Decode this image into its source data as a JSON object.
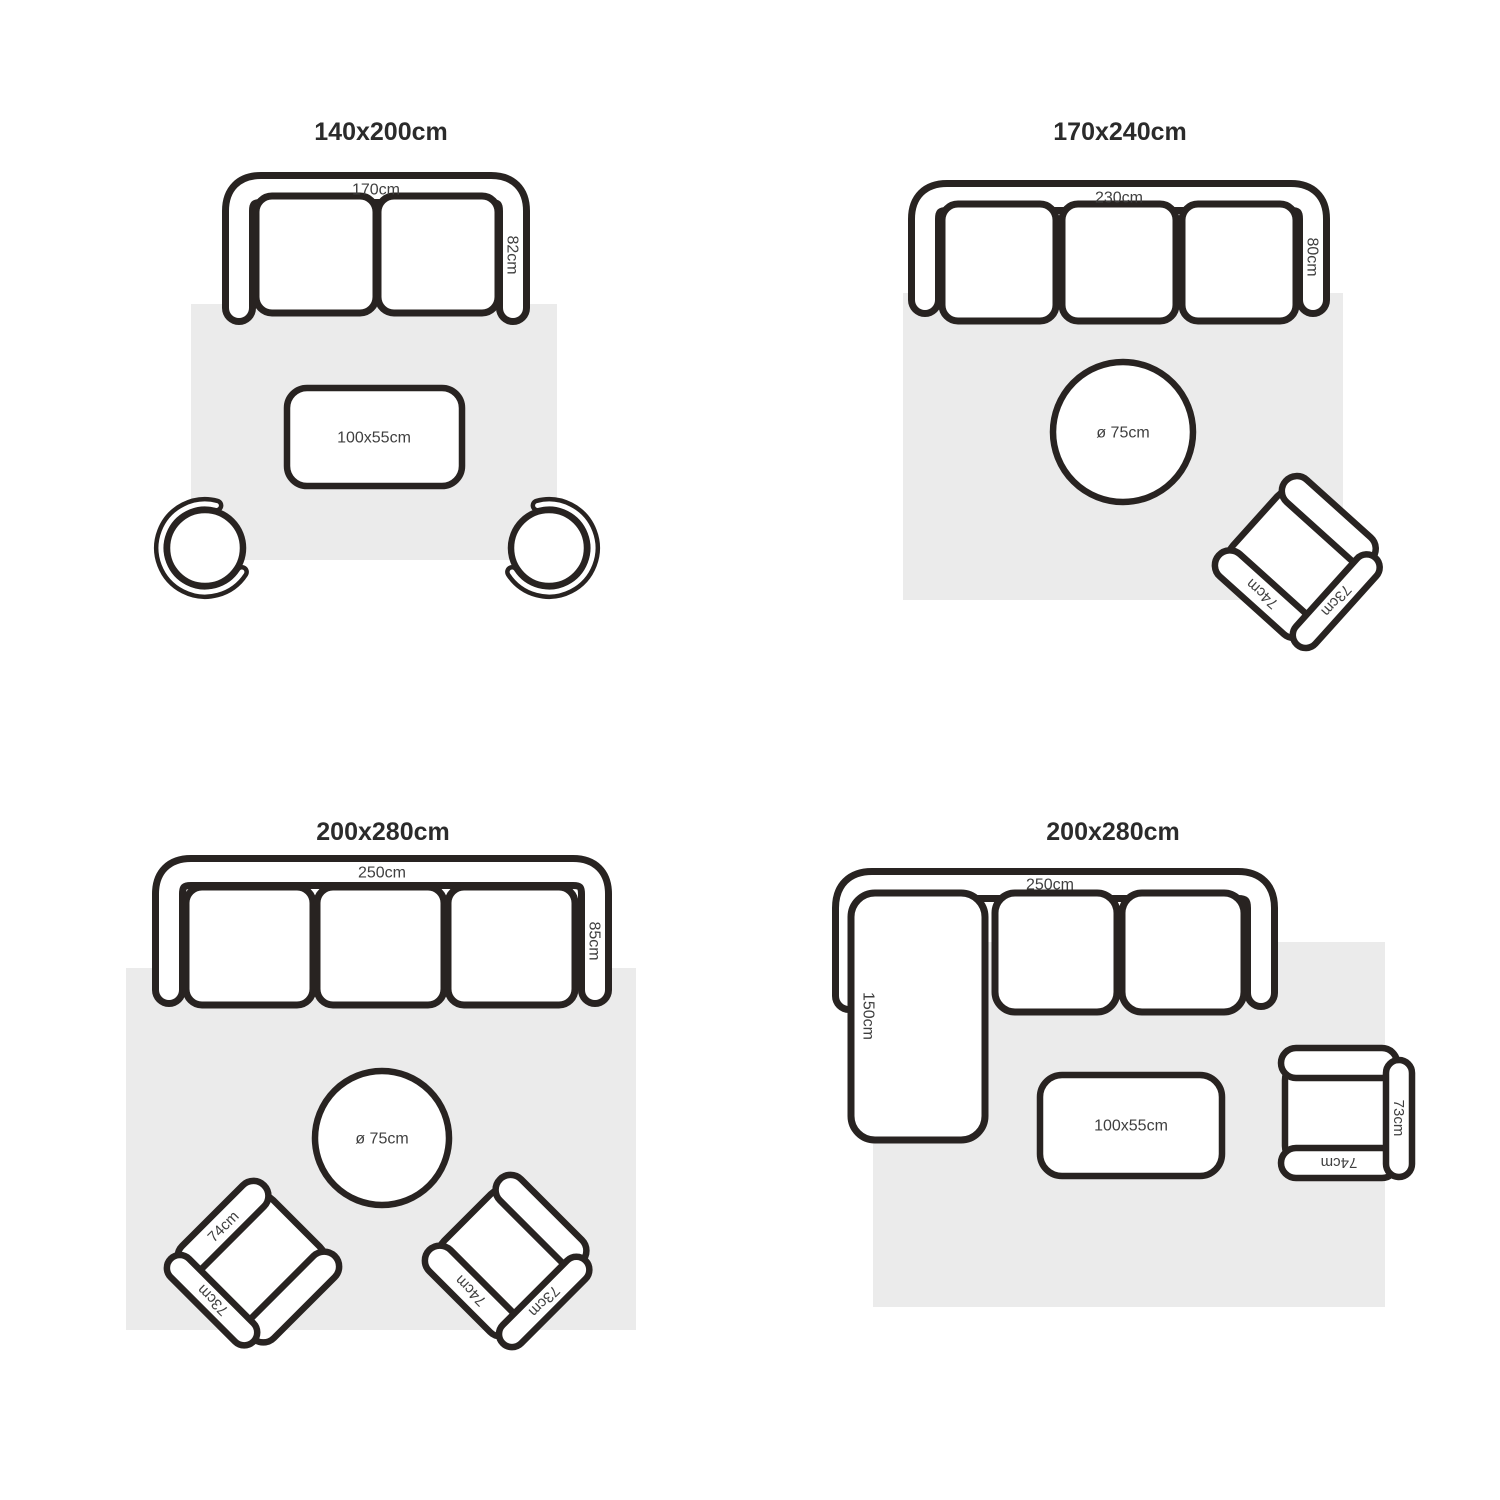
{
  "colors": {
    "outline": "#282321",
    "rug": "#ebebeb",
    "label": "#3f3f3f",
    "title": "#2b2b2b",
    "background": "#ffffff"
  },
  "panels": [
    {
      "title": "140x200cm",
      "sofa": {
        "seats": 2,
        "width_label": "170cm",
        "depth_label": "82cm"
      },
      "coffee_table": {
        "shape": "rectangle",
        "label": "100x55cm"
      },
      "chairs": [
        {
          "type": "round-swivel"
        },
        {
          "type": "round-swivel"
        }
      ]
    },
    {
      "title": "170x240cm",
      "sofa": {
        "seats": 3,
        "width_label": "230cm",
        "depth_label": "80cm"
      },
      "coffee_table": {
        "shape": "round",
        "label": "ø 75cm"
      },
      "armchair": {
        "back_label": "73cm",
        "arm_label": "74cm"
      }
    },
    {
      "title": "200x280cm",
      "sofa": {
        "seats": 3,
        "width_label": "250cm",
        "depth_label": "85cm"
      },
      "coffee_table": {
        "shape": "round",
        "label": "ø 75cm"
      },
      "armchairs": [
        {
          "back_label": "73cm",
          "arm_label": "74cm"
        },
        {
          "back_label": "73cm",
          "arm_label": "74cm"
        }
      ]
    },
    {
      "title": "200x280cm",
      "sofa": {
        "seats": 3,
        "type": "sectional-chaise",
        "width_label": "250cm",
        "chaise_label": "150cm"
      },
      "coffee_table": {
        "shape": "rectangle",
        "label": "100x55cm"
      },
      "armchair": {
        "back_label": "73cm",
        "arm_label": "74cm"
      }
    }
  ]
}
